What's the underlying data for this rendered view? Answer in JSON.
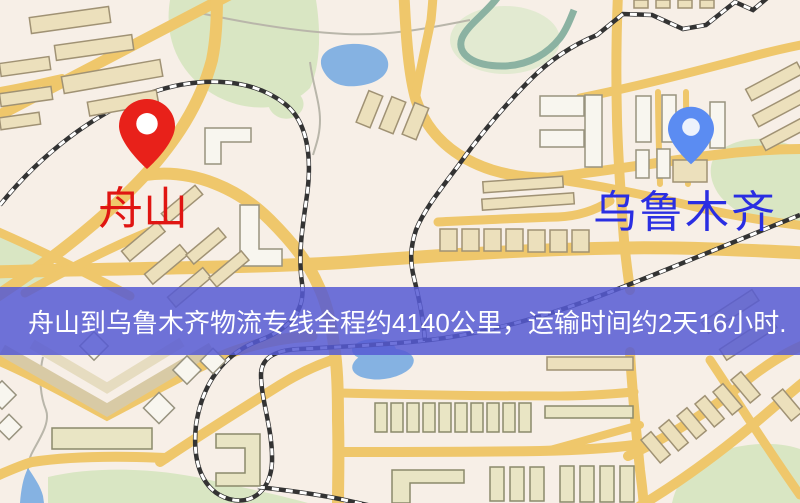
{
  "banner": {
    "text": "舟山到乌鲁木齐物流专线全程约4140公里，运输时间约2天16小时.",
    "background_color": "#565ad4",
    "text_color": "#ffffff"
  },
  "markers": {
    "origin": {
      "label": "舟山",
      "pin_color": "#e8211a",
      "pin_hole_color": "#ffffff",
      "label_color": "#e01512"
    },
    "destination": {
      "label": "乌鲁木齐",
      "pin_color": "#5b8cf2",
      "pin_hole_color": "#edf2fc",
      "label_color": "#2a2ee2"
    }
  },
  "route_facts": {
    "distance": "约4140公里",
    "duration": "约2天16小时"
  },
  "map_palette": {
    "background": "#f7efe7",
    "road": "#efc76b",
    "water": "#85b2e2",
    "green_area": "#d9e6c3",
    "railway": "#333333",
    "building_tan": "#ece0bc",
    "building_white": "#f8f6ef",
    "building_khaki": "#e9e5c4"
  }
}
